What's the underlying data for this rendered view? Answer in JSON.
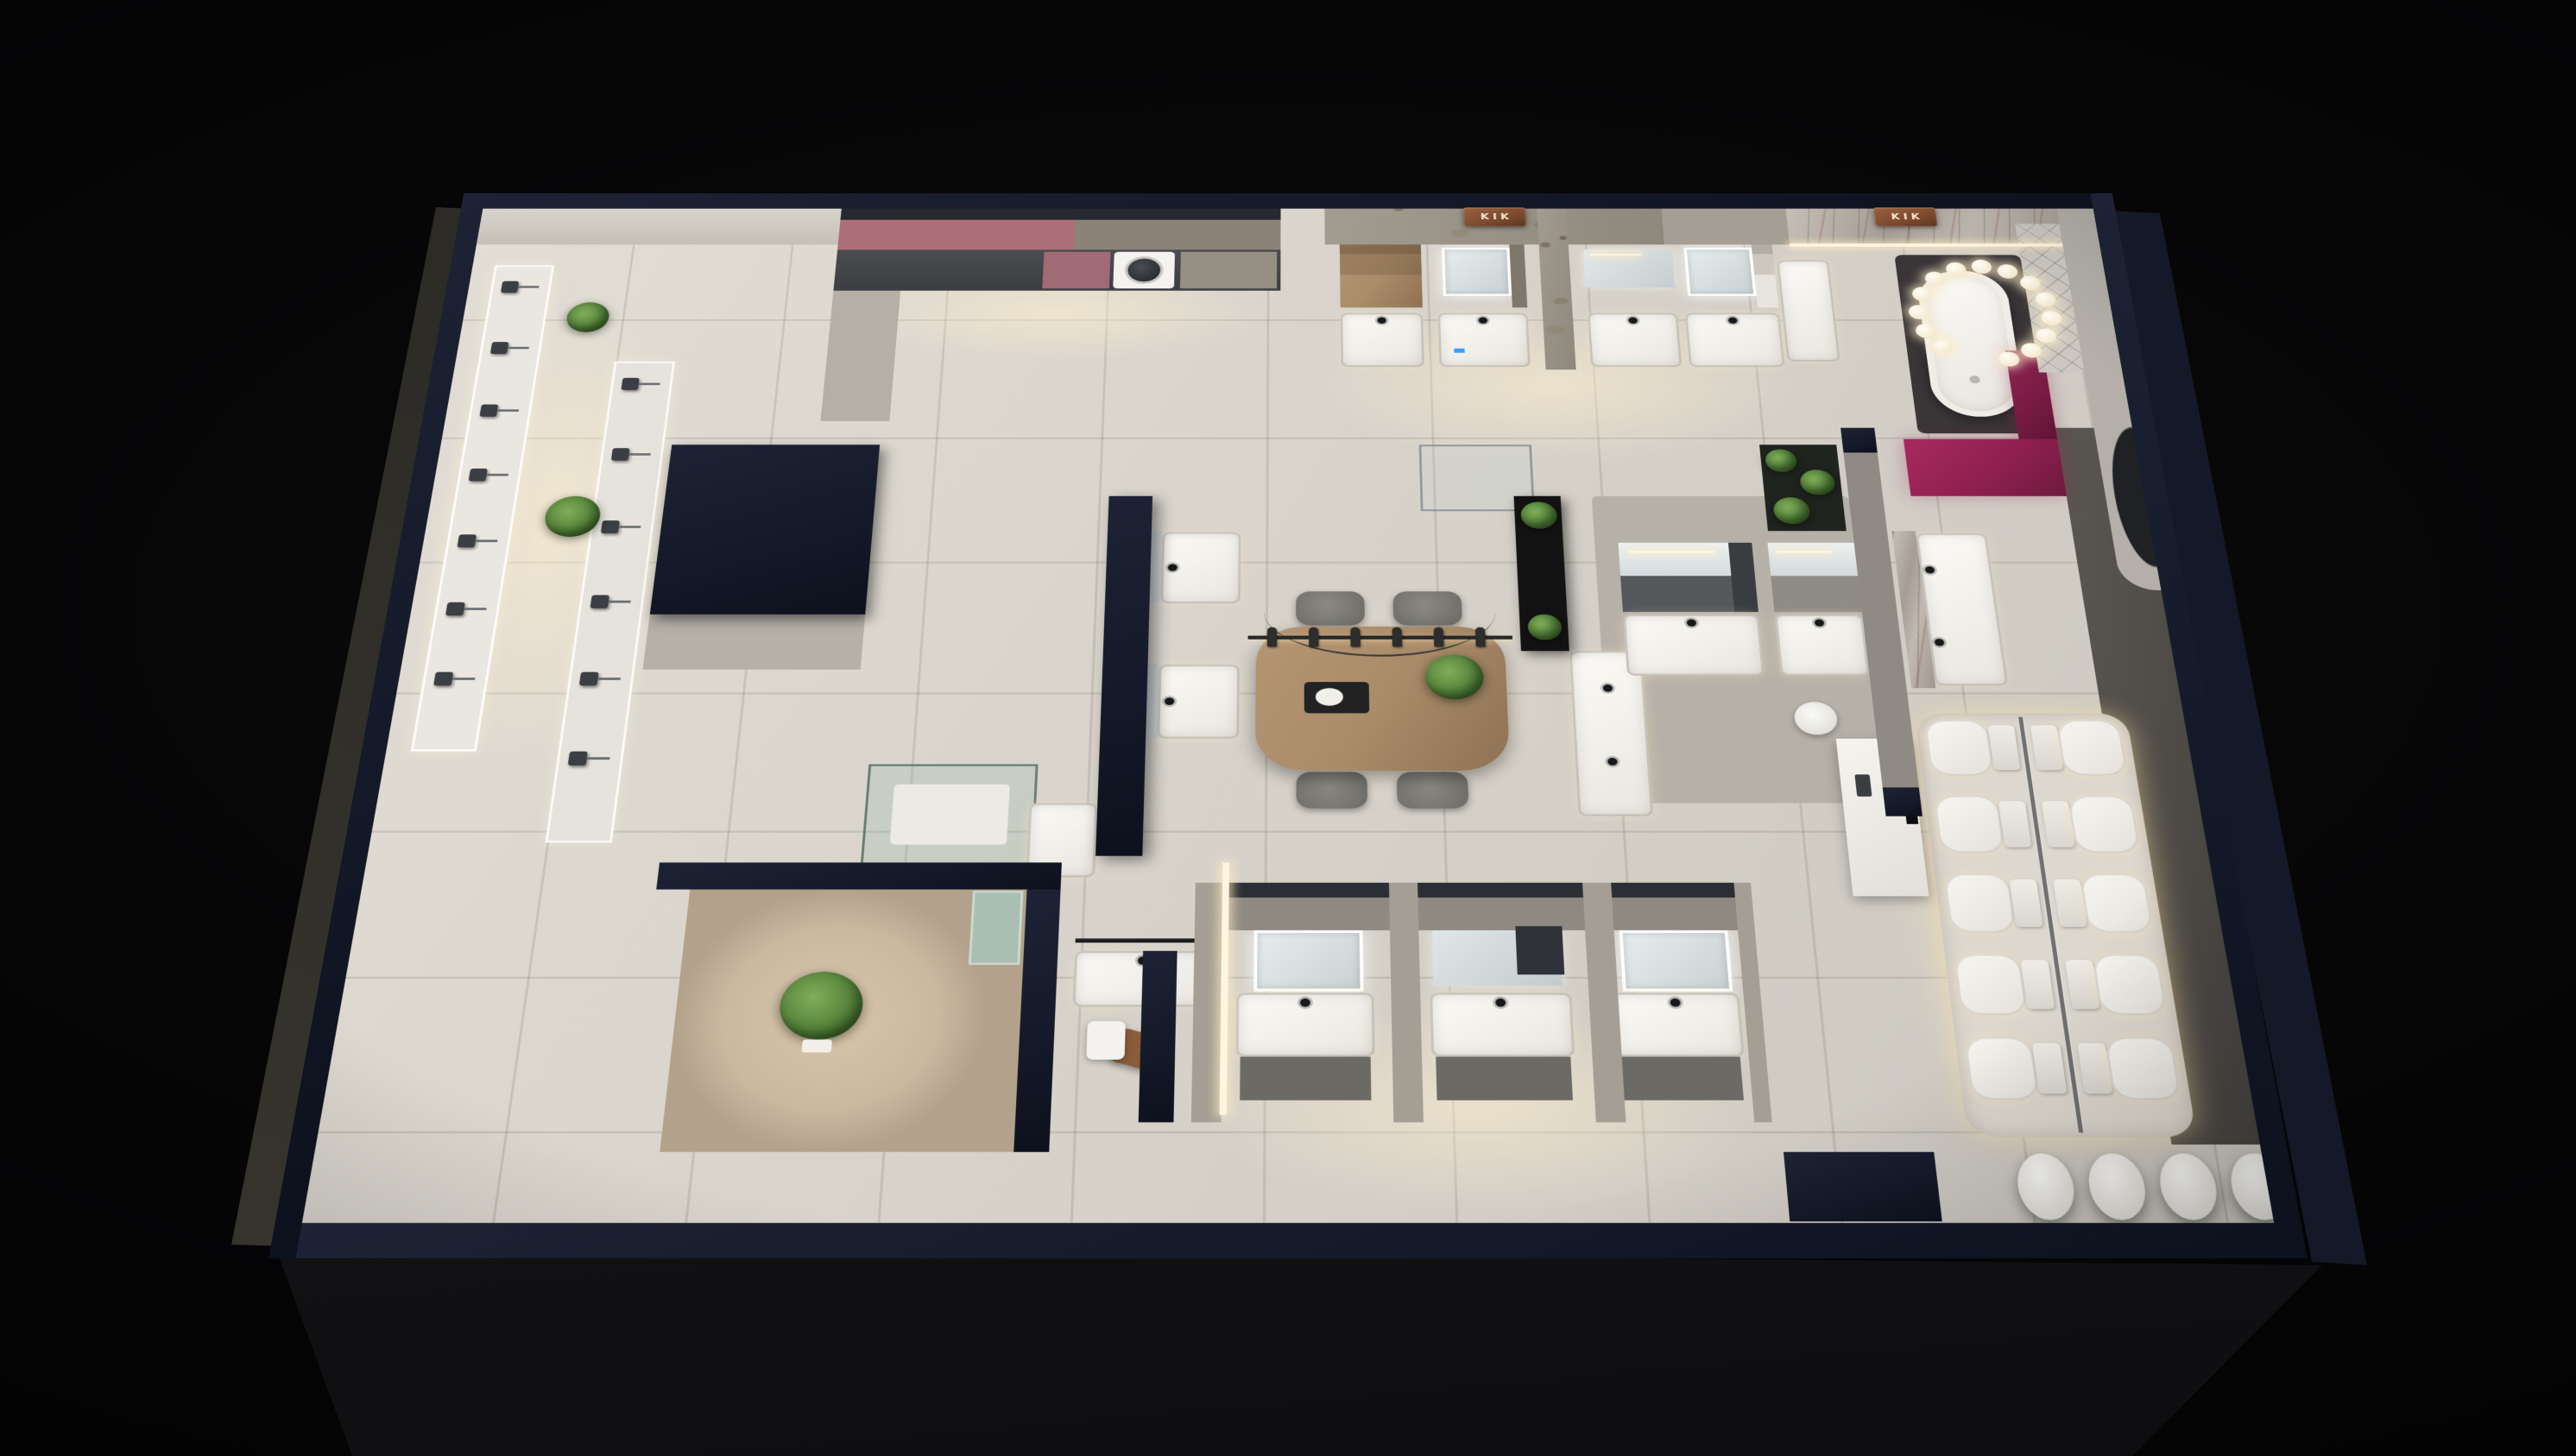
{
  "meta": {
    "scene": "Night-time 3D dollhouse cutaway render of a bathroom-fixture showroom",
    "view": "top-down perspective, dark void background, warm interior lighting"
  },
  "signs": {
    "stone_wall": "KIK",
    "marble_wall": "KIK"
  },
  "palette": {
    "background": "#060607",
    "wall_navy": "#151a2a",
    "floor_light": "#d8d4cc",
    "floor_warm": "#efe6d2",
    "concrete": "#a49e94",
    "stone": "#9c958a",
    "marble": "#b7b0a8",
    "marble_vein_red": "#7d3b2f",
    "magenta": "#8f2050",
    "copper": "#7d4a2e",
    "wood": "#a98c69",
    "plant_green": "#5d8a41",
    "led_warm": "#ffe3b0",
    "glass_teal": "#8fae9f",
    "fixture_white": "#f2f0ea",
    "cabinet_charcoal": "#54585b",
    "facade_gray": "#1b1b1d"
  },
  "fixtures": {
    "shower_display_wall_primary": {
      "label": "rain-shower display wall",
      "heads": 7
    },
    "shower_display_wall_secondary": {
      "label": "shower-column display wall",
      "heads": 6
    },
    "hanging_faucet_rail": {
      "label": "suspended faucet display rail over table",
      "faucets": 6
    },
    "meeting_table": {
      "label": "wood consultation table",
      "chairs": 4
    },
    "toilet_display": {
      "label": "back-to-back toilet display platform",
      "rows": 5,
      "per_row": 2
    },
    "bubble_chandelier": {
      "label": "bubble ring chandelier over bathtub",
      "bulbs": 14
    },
    "freestanding_tub": {
      "label": "freestanding bathtub on dark terrazzo mat",
      "count": 1
    },
    "front_wall_basins": {
      "label": "freestanding basins along front wall",
      "count": 4
    },
    "top_vanity_bays": {
      "label": "wall-hung vanity bays on back wall",
      "count": 4
    },
    "bottom_vanity_alcoves": {
      "label": "vanity display alcoves",
      "count": 3
    },
    "washing_machine": {
      "label": "washer built into laundry run",
      "count": 1
    }
  }
}
